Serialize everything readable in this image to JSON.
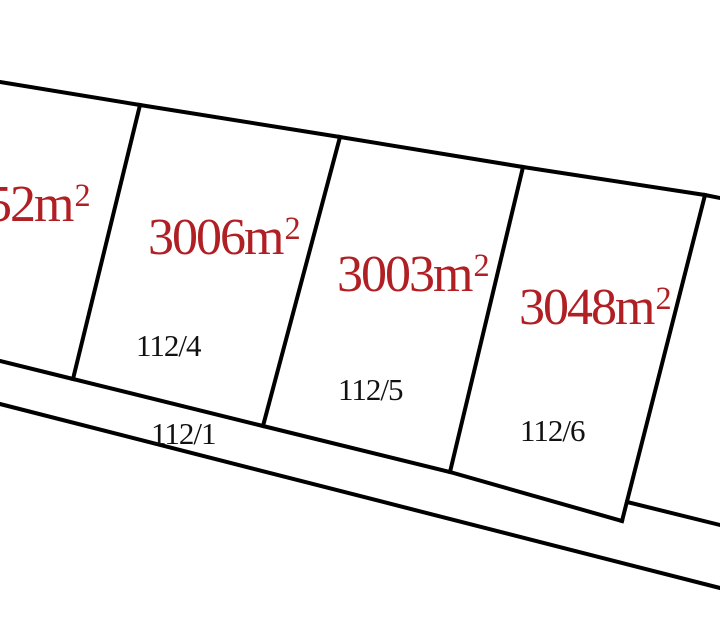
{
  "canvas": {
    "width": 720,
    "height": 618,
    "background": "#ffffff"
  },
  "colors": {
    "boundary_line": "#000000",
    "area_label_text": "#B01F23",
    "parcel_number_text": "#111111"
  },
  "parcels": [
    {
      "id": "left-edge-parcel",
      "area_value": "52m",
      "area_sup": "2",
      "number": ""
    },
    {
      "id": "parcel-112-4",
      "area_value": "3006m",
      "area_sup": "2",
      "number": "112/4"
    },
    {
      "id": "parcel-112-5",
      "area_value": "3003m",
      "area_sup": "2",
      "number": "112/5"
    },
    {
      "id": "parcel-112-6",
      "area_value": "3048m",
      "area_sup": "2",
      "number": "112/6"
    }
  ],
  "road": {
    "number": "112/1"
  }
}
